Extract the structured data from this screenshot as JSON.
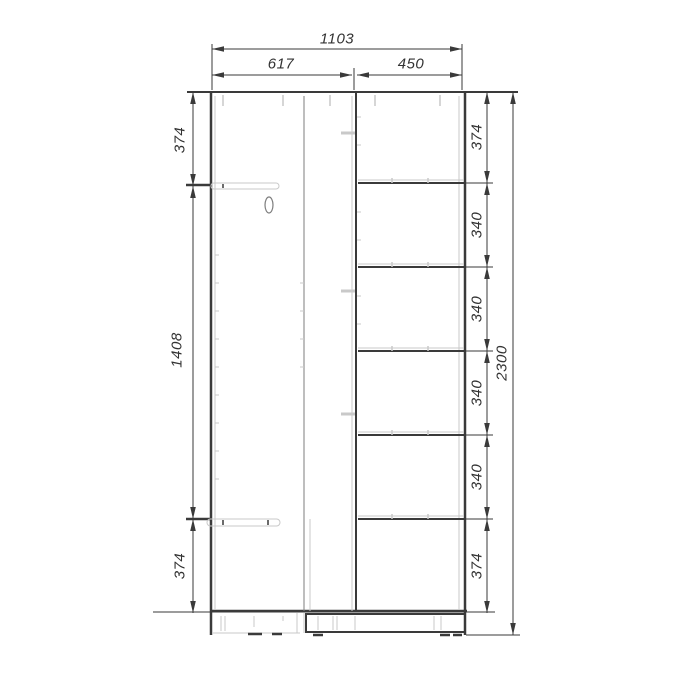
{
  "drawing": {
    "type": "technical-drawing",
    "subject": "two-section wardrobe front elevation with dimension chains",
    "units": "mm",
    "top_dims": {
      "overall": "1103",
      "left_section": "617",
      "right_section": "450"
    },
    "left_chain": {
      "top": "374",
      "middle": "1408",
      "bottom": "374"
    },
    "right_chain": [
      "374",
      "340",
      "340",
      "340",
      "340",
      "374"
    ],
    "overall_height": "2300",
    "colors": {
      "line_dark": "#3a3a3a",
      "line_mid": "#7d7d7d",
      "line_light": "#c9c9c9",
      "text": "#333333",
      "background": "#ffffff"
    }
  }
}
